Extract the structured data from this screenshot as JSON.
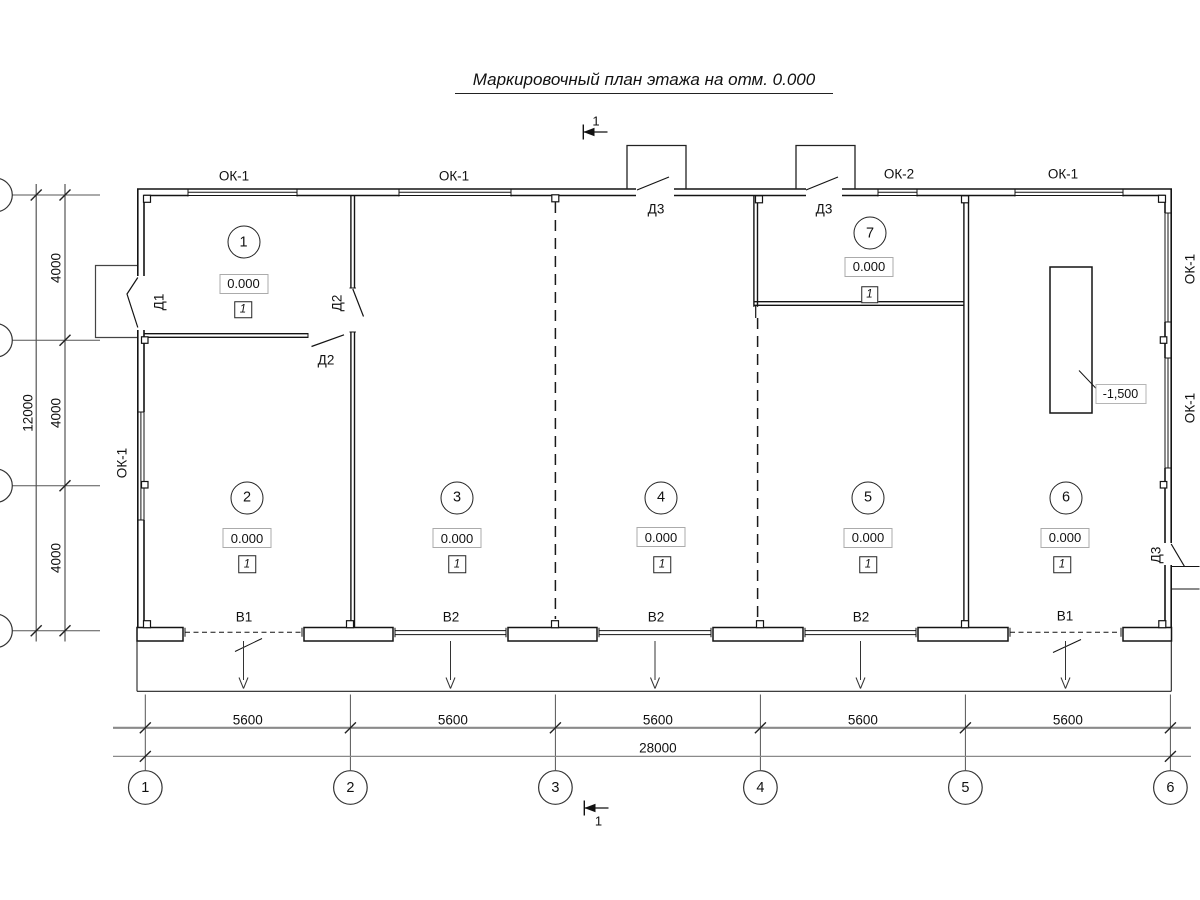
{
  "title": "Маркировочный план этажа на отм. 0.000",
  "section_marks": {
    "top": "1",
    "bottom": "1"
  },
  "rooms": [
    {
      "number": "1",
      "elevation": "0.000",
      "floor_type": "1"
    },
    {
      "number": "2",
      "elevation": "0.000",
      "floor_type": "1"
    },
    {
      "number": "3",
      "elevation": "0.000",
      "floor_type": "1"
    },
    {
      "number": "4",
      "elevation": "0.000",
      "floor_type": "1"
    },
    {
      "number": "5",
      "elevation": "0.000",
      "floor_type": "1"
    },
    {
      "number": "6",
      "elevation": "0.000",
      "floor_type": "1"
    },
    {
      "number": "7",
      "elevation": "0.000",
      "floor_type": "1"
    }
  ],
  "labels": {
    "windows_top": [
      "ОК-1",
      "ОК-1",
      "ОК-2",
      "ОК-1"
    ],
    "window_left": "ОК-1",
    "windows_right": [
      "ОК-1",
      "ОК-1"
    ],
    "doors": {
      "d1": "Д1",
      "d2_upper": "Д2",
      "d2_lower": "Д2",
      "d3_top_left": "Д3",
      "d3_top_right": "Д3",
      "d3_side": "Д3"
    },
    "gates": [
      "В1",
      "В2",
      "В2",
      "В2",
      "В1"
    ],
    "pit_elevation": "-1,500"
  },
  "dimensions": {
    "bottom_segments": [
      "5600",
      "5600",
      "5600",
      "5600",
      "5600"
    ],
    "bottom_total": "28000",
    "left_segments": [
      "4000",
      "4000",
      "4000"
    ],
    "left_total": "12000"
  },
  "grid": {
    "columns": [
      "1",
      "2",
      "3",
      "4",
      "5",
      "6"
    ]
  }
}
